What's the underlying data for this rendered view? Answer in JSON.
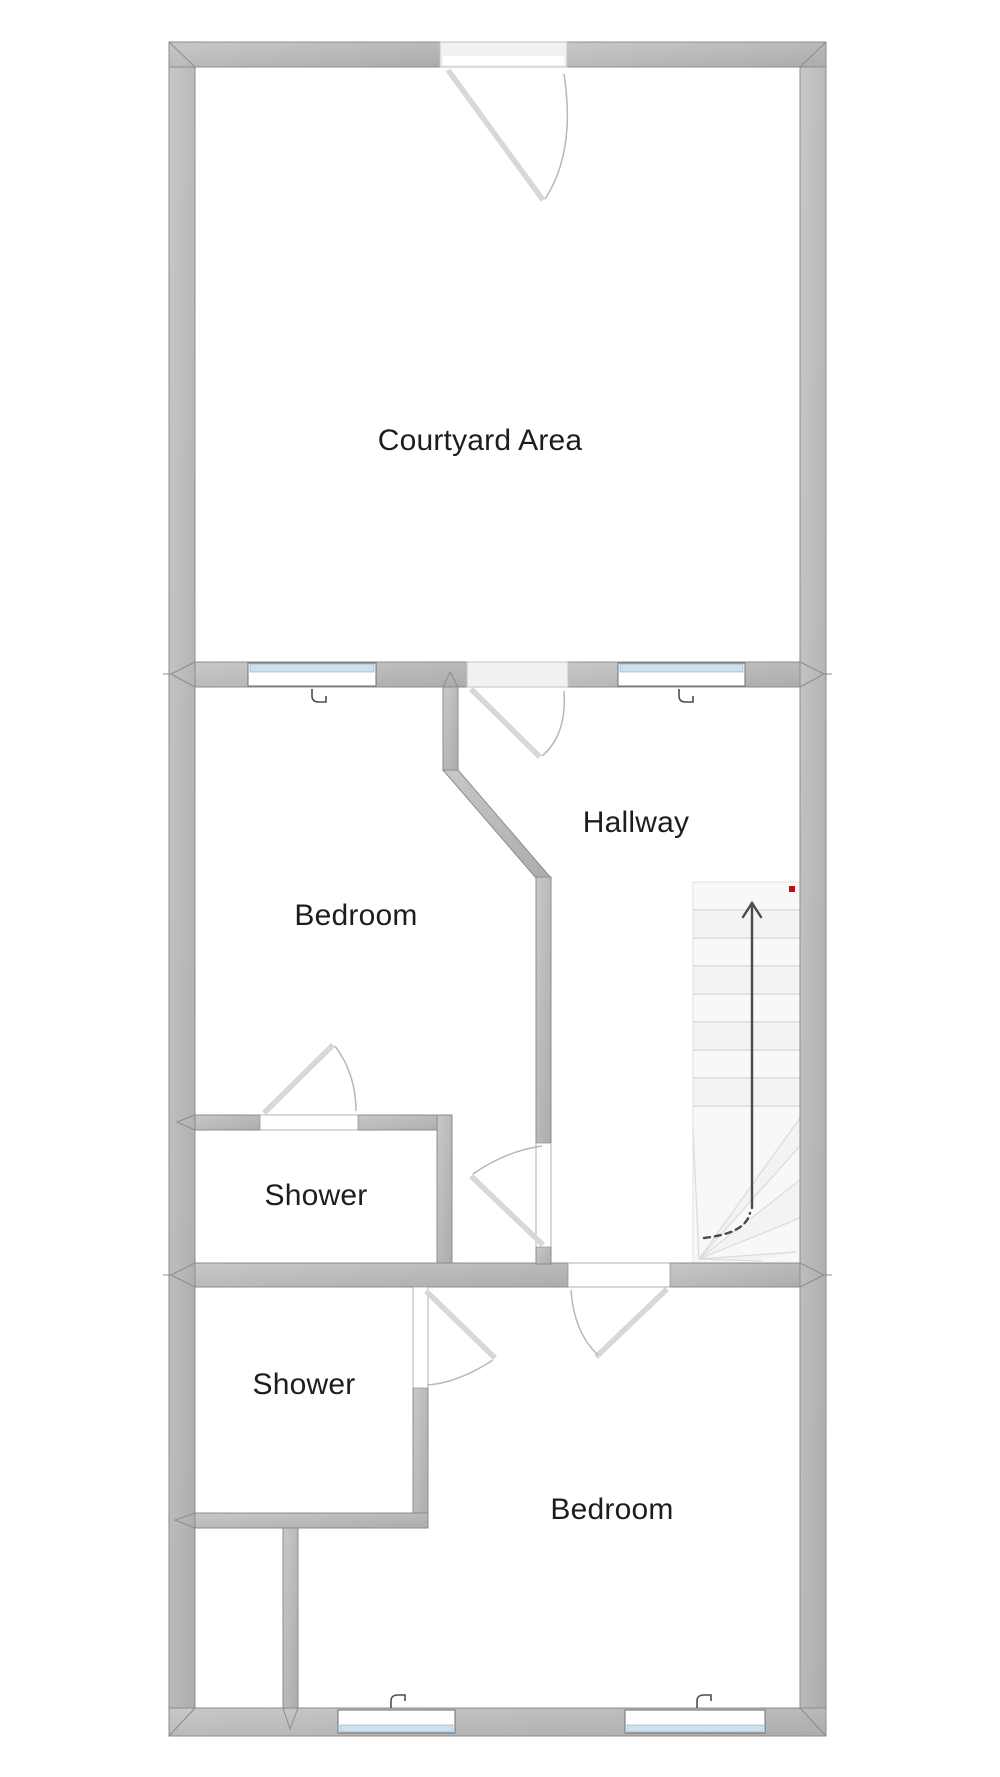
{
  "diagram": {
    "type": "floor-plan",
    "rooms": [
      {
        "id": "courtyard",
        "label": "Courtyard Area"
      },
      {
        "id": "bedroom-upper",
        "label": "Bedroom"
      },
      {
        "id": "hallway",
        "label": "Hallway"
      },
      {
        "id": "shower-upper",
        "label": "Shower"
      },
      {
        "id": "shower-lower",
        "label": "Shower"
      },
      {
        "id": "bedroom-lower",
        "label": "Bedroom"
      }
    ],
    "colors": {
      "wall": "#b4b4b4",
      "wall_edge": "#8c8c8c",
      "wall_hi": "#cdcdcd",
      "window_glass": "#cde1ef",
      "door_leaf": "#d8d8d8",
      "door_arc": "#b8b8b8",
      "stair_tread": "#dcdcdc",
      "arrow": "#4a4a4a",
      "red_marker": "#c40d0d",
      "label_text": "#1d1d1d",
      "background": "#ffffff"
    }
  }
}
